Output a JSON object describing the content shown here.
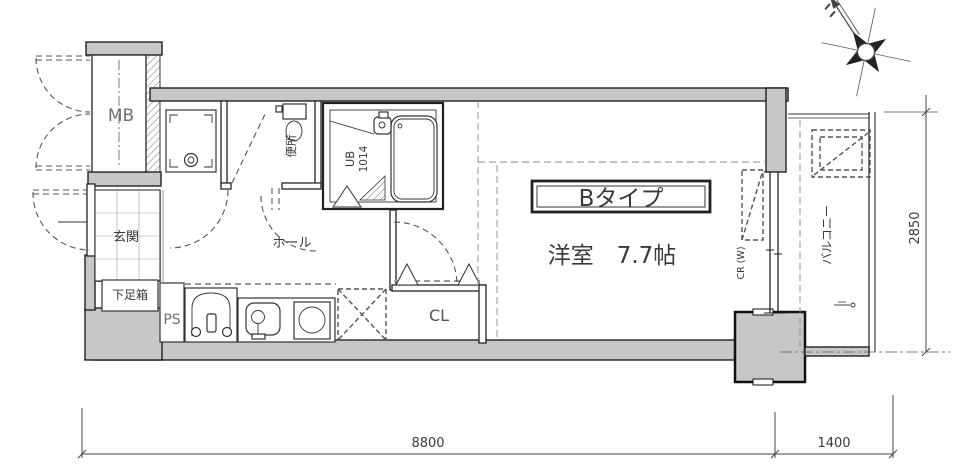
{
  "plan": {
    "type_label": "Bタイプ",
    "room_size_label": "洋室　7.7帖"
  },
  "rooms": {
    "meter_box": "MB",
    "toilet": "便所",
    "unit_bath": "UB",
    "unit_bath_size": "1014",
    "hall": "ホール",
    "entrance": "玄関",
    "shoe_cabinet": "下足箱",
    "pipe_space": "PS",
    "closet": "CL",
    "curtain_rail": "CR (W)",
    "balcony": "バルコニー"
  },
  "dimensions": {
    "main_width_mm": "8800",
    "balcony_width_mm": "1400",
    "depth_mm": "2850"
  },
  "icons": {
    "compass": "compass-rose"
  },
  "colors": {
    "background": "#ffffff",
    "wall_fill": "#c7c7c7",
    "line": "#2f2f2f",
    "label": "#3a3a3a"
  }
}
